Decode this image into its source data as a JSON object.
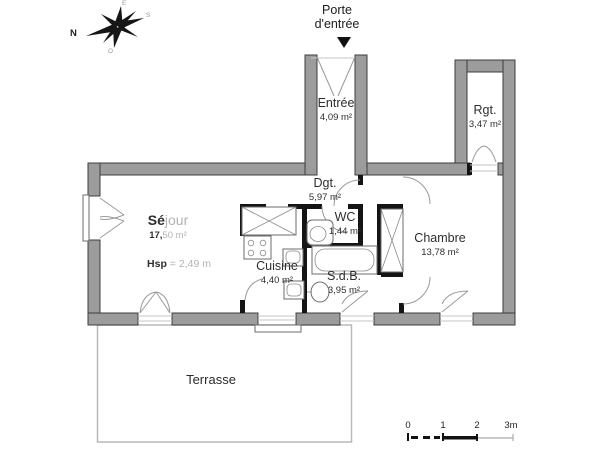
{
  "plan": {
    "entrance_note": {
      "line1": "Porte",
      "line2": "d'entrée"
    },
    "compass": {
      "north": "N",
      "east": "E",
      "south": "S",
      "west": "O"
    },
    "rooms": {
      "entree": {
        "name": "Entrée",
        "area": "4,09 m²"
      },
      "rgt": {
        "name": "Rgt.",
        "area": "3,47 m²"
      },
      "dgt": {
        "name": "Dgt.",
        "area": "5,97 m²"
      },
      "wc": {
        "name": "WC",
        "area": "1,44 m²"
      },
      "sejour": {
        "name_dark": "Sé",
        "name_light": "jour",
        "area_dark": "17,",
        "area_light": "50 m²",
        "hsp_dark": "Hsp",
        "hsp_light": "= 2,49 m"
      },
      "cuisine": {
        "name": "Cuisine",
        "area": "4,40 m²"
      },
      "sdb": {
        "name": "S.d.B.",
        "area": "3,95 m²"
      },
      "chambre": {
        "name": "Chambre",
        "area": "13,78 m²"
      },
      "terrasse": {
        "name": "Terrasse"
      }
    },
    "scale_bar": {
      "t0": "0",
      "t1": "1",
      "t2": "2",
      "t3": "3m"
    },
    "colors": {
      "wall_fill": "#9c9c9c",
      "wall_stroke": "#3d3d3d",
      "partition": "#141414",
      "door_arc": "#9a9a9a",
      "fixture_stroke": "#6b6b6b",
      "terrace_stroke": "#b9b9b9",
      "text": "#2e2e2e",
      "faded_text": "#b3b3b3",
      "background": "#ffffff"
    }
  }
}
